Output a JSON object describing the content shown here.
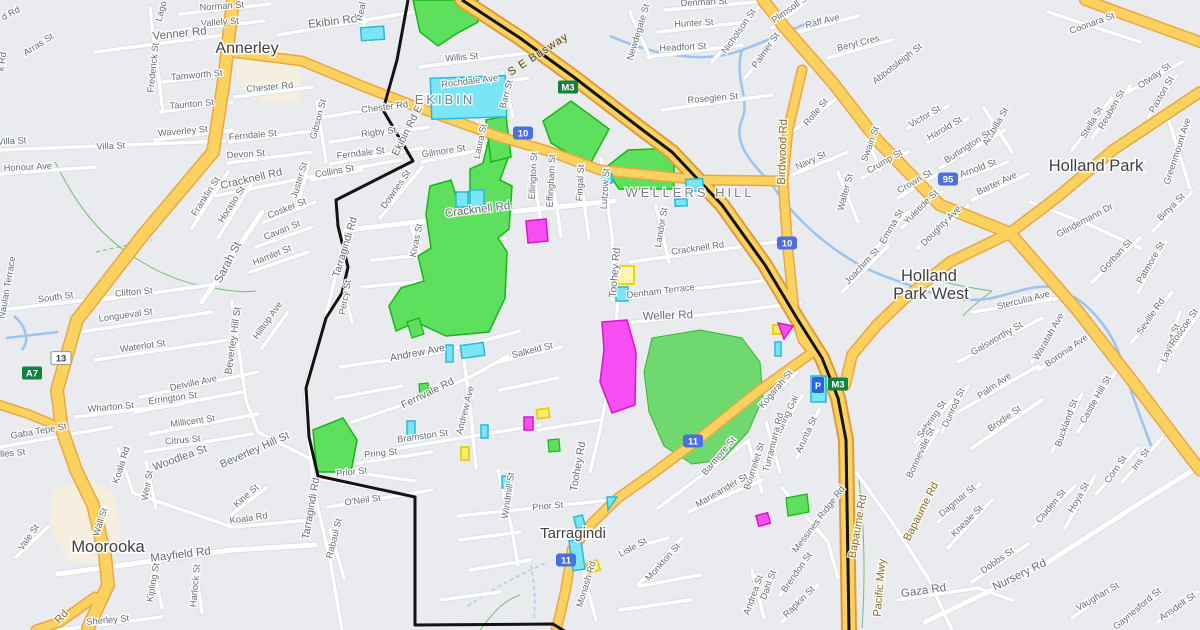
{
  "colors": {
    "bg": "#e9ebee",
    "road_white": "#ffffff",
    "road_casing": "#d9dbdf",
    "road_yellow": "#fbd160",
    "road_yellow_casing": "#eba743",
    "motorway_fill": "#fbd160",
    "motorway_casing": "#de9a3b",
    "boundary_black": "#131313",
    "water": "#9dc3f0",
    "park_fill": "#5ee05e",
    "park_stroke": "#15b715",
    "park_soft": "#6fd86f",
    "parcel_cyan": "#7ae6f5",
    "parcel_cyan_stroke": "#2bb8d8",
    "parcel_magenta": "#f74ef3",
    "parcel_magenta_stroke": "#d816ce",
    "parcel_yellow": "#f9ed6a",
    "parcel_yellow_stroke": "#e8cf1a",
    "parcel_blue": "#2a66d9",
    "commercial": "#f6efdf",
    "shield_green": "#12813f",
    "shield_blue": "#4a6fdf",
    "trail_green": "#4caf50"
  },
  "suburbs": [
    {
      "t": "Annerley",
      "x": 247,
      "y": 53,
      "s": 16
    },
    {
      "t": "EKIBIN",
      "x": 445,
      "y": 104,
      "caps": true
    },
    {
      "t": "WELLERS HILL",
      "x": 690,
      "y": 197,
      "caps": true
    },
    {
      "t": "Holland Park",
      "x": 1096,
      "y": 171,
      "s": 16.5
    },
    {
      "t": "Holland",
      "x": 929,
      "y": 281,
      "s": 16.5
    },
    {
      "t": "Park West",
      "x": 931,
      "y": 299,
      "s": 16.5
    },
    {
      "t": "Moorooka",
      "x": 108,
      "y": 552,
      "s": 16.5
    },
    {
      "t": "Tarragindi",
      "x": 573,
      "y": 538,
      "s": 15
    }
  ],
  "shields": [
    {
      "t": "M3",
      "x": 568,
      "y": 87,
      "k": "g"
    },
    {
      "t": "M3",
      "x": 838,
      "y": 384,
      "k": "g"
    },
    {
      "t": "10",
      "x": 523,
      "y": 133,
      "k": "b"
    },
    {
      "t": "10",
      "x": 787,
      "y": 243,
      "k": "b"
    },
    {
      "t": "11",
      "x": 693,
      "y": 441,
      "k": "b"
    },
    {
      "t": "11",
      "x": 566,
      "y": 560,
      "k": "b"
    },
    {
      "t": "95",
      "x": 948,
      "y": 179,
      "k": "b"
    },
    {
      "t": "13",
      "x": 61,
      "y": 358,
      "k": "w"
    },
    {
      "t": "A7",
      "x": 32,
      "y": 373,
      "k": "g"
    }
  ],
  "streets": [
    {
      "t": "Norman St",
      "x": 222,
      "y": 9,
      "r": -4
    },
    {
      "t": "Vallely St",
      "x": 220,
      "y": 25,
      "r": -4
    },
    {
      "t": "Venner Rd",
      "x": 180,
      "y": 37,
      "r": -6,
      "s": 11.5
    },
    {
      "t": "Arras St",
      "x": 40,
      "y": 47,
      "r": -33
    },
    {
      "t": "d Rd",
      "x": 12,
      "y": 16,
      "r": -28
    },
    {
      "t": "k Rd",
      "x": 5,
      "y": 62,
      "r": -82
    },
    {
      "t": "Lago",
      "x": 164,
      "y": 12,
      "r": -75
    },
    {
      "t": "Frederick St",
      "x": 156,
      "y": 68,
      "r": -84
    },
    {
      "t": "Tamworth St",
      "x": 197,
      "y": 78,
      "r": -5
    },
    {
      "t": "Chester Rd",
      "x": 270,
      "y": 90,
      "r": -5
    },
    {
      "t": "Taunton St",
      "x": 192,
      "y": 107,
      "r": -5
    },
    {
      "t": "Waverley St",
      "x": 183,
      "y": 134,
      "r": -5
    },
    {
      "t": "Ferndale St",
      "x": 253,
      "y": 138,
      "r": -5
    },
    {
      "t": "Villa St",
      "x": 111,
      "y": 149,
      "r": -3
    },
    {
      "t": "Villa St",
      "x": 12,
      "y": 144,
      "r": -3
    },
    {
      "t": "Devon St",
      "x": 246,
      "y": 157,
      "r": -4
    },
    {
      "t": "Honour Ave",
      "x": 28,
      "y": 170,
      "r": -3
    },
    {
      "t": "Ekibin Rd",
      "x": 333,
      "y": 25,
      "r": -7,
      "s": 11.5
    },
    {
      "t": "Real",
      "x": 364,
      "y": 12,
      "r": -80
    },
    {
      "t": "Willis St",
      "x": 462,
      "y": 60,
      "r": -5
    },
    {
      "t": "Rochdale Ave",
      "x": 470,
      "y": 84,
      "r": -7
    },
    {
      "t": "Chester Rd",
      "x": 385,
      "y": 110,
      "r": -7
    },
    {
      "t": "Gibson St",
      "x": 321,
      "y": 120,
      "r": -75
    },
    {
      "t": "Rigby St",
      "x": 379,
      "y": 135,
      "r": -7
    },
    {
      "t": "Ferndale St",
      "x": 361,
      "y": 156,
      "r": -7
    },
    {
      "t": "Gilmore St",
      "x": 444,
      "y": 154,
      "r": -9
    },
    {
      "t": "Laura St",
      "x": 483,
      "y": 142,
      "r": -78
    },
    {
      "t": "Barr St",
      "x": 509,
      "y": 95,
      "r": -75
    },
    {
      "t": "Ekibin Rd E",
      "x": 410,
      "y": 132,
      "r": -63,
      "s": 10.5
    },
    {
      "t": "Downes St",
      "x": 398,
      "y": 191,
      "r": -55
    },
    {
      "t": "Collins St",
      "x": 335,
      "y": 174,
      "r": -10
    },
    {
      "t": "S E Busway",
      "x": 540,
      "y": 57,
      "r": -33,
      "k": "bus"
    },
    {
      "t": "Cracknell Rd",
      "x": 252,
      "y": 182,
      "r": -13,
      "s": 11
    },
    {
      "t": "Franklin St",
      "x": 208,
      "y": 198,
      "r": -57
    },
    {
      "t": "Horatio St",
      "x": 234,
      "y": 206,
      "r": -57
    },
    {
      "t": "Cosker St",
      "x": 288,
      "y": 211,
      "r": -22
    },
    {
      "t": "Cavan St",
      "x": 283,
      "y": 233,
      "r": -22
    },
    {
      "t": "Hamlet St",
      "x": 273,
      "y": 258,
      "r": -22
    },
    {
      "t": "Sarah St",
      "x": 231,
      "y": 264,
      "r": -62,
      "s": 11.5
    },
    {
      "t": "Juster St",
      "x": 302,
      "y": 181,
      "r": -73
    },
    {
      "t": "Cracknell Rd",
      "x": 478,
      "y": 213,
      "r": -7,
      "s": 11.5
    },
    {
      "t": "Kivas St",
      "x": 419,
      "y": 241,
      "r": -78
    },
    {
      "t": "Tarragindi Rd",
      "x": 348,
      "y": 248,
      "r": -73,
      "s": 10.5
    },
    {
      "t": "Percy St",
      "x": 348,
      "y": 298,
      "r": -80
    },
    {
      "t": "Ellington St",
      "x": 536,
      "y": 176,
      "r": -87
    },
    {
      "t": "Effingham St",
      "x": 554,
      "y": 181,
      "r": -87
    },
    {
      "t": "Fingal St",
      "x": 583,
      "y": 183,
      "r": -87
    },
    {
      "t": "Lutzow St",
      "x": 608,
      "y": 189,
      "r": -86
    },
    {
      "t": "Landor St",
      "x": 664,
      "y": 228,
      "r": -80
    },
    {
      "t": "Cracknell Rd",
      "x": 698,
      "y": 251,
      "r": -8
    },
    {
      "t": "Toohey Rd",
      "x": 618,
      "y": 273,
      "r": -85,
      "s": 10.5
    },
    {
      "t": "Denham Terrace",
      "x": 661,
      "y": 294,
      "r": -7
    },
    {
      "t": "Weller Rd",
      "x": 668,
      "y": 319,
      "r": -2,
      "s": 11.5
    },
    {
      "t": "Birdwood Rd",
      "x": 786,
      "y": 152,
      "r": -88,
      "s": 11.5,
      "k": "rd"
    },
    {
      "t": "Navy St",
      "x": 812,
      "y": 163,
      "r": -25
    },
    {
      "t": "Walter St",
      "x": 848,
      "y": 193,
      "r": -75
    },
    {
      "t": "Crump St",
      "x": 886,
      "y": 164,
      "r": -30
    },
    {
      "t": "Joachim St",
      "x": 864,
      "y": 268,
      "r": -47
    },
    {
      "t": "Emma St",
      "x": 894,
      "y": 228,
      "r": -60
    },
    {
      "t": "Denman St",
      "x": 704,
      "y": 5,
      "r": -3
    },
    {
      "t": "Hunter St",
      "x": 694,
      "y": 26,
      "r": -3
    },
    {
      "t": "Headfort St",
      "x": 683,
      "y": 50,
      "r": -3
    },
    {
      "t": "Newdegate St",
      "x": 641,
      "y": 33,
      "r": -73
    },
    {
      "t": "Nicholson St",
      "x": 741,
      "y": 33,
      "r": -55
    },
    {
      "t": "Palmer St",
      "x": 768,
      "y": 52,
      "r": -55
    },
    {
      "t": "Plimsoll St",
      "x": 792,
      "y": 11,
      "r": -35
    },
    {
      "t": "Raff Ave",
      "x": 823,
      "y": 24,
      "r": -14
    },
    {
      "t": "Beryl Cres",
      "x": 859,
      "y": 46,
      "r": -14
    },
    {
      "t": "Abbotsleigh St",
      "x": 899,
      "y": 66,
      "r": -38
    },
    {
      "t": "Roseglen St",
      "x": 713,
      "y": 101,
      "r": -5
    },
    {
      "t": "Rolle St",
      "x": 818,
      "y": 114,
      "r": -50
    },
    {
      "t": "Swain St",
      "x": 873,
      "y": 145,
      "r": -70
    },
    {
      "t": "Coonara St",
      "x": 1093,
      "y": 26,
      "r": -20
    },
    {
      "t": "Victor St",
      "x": 926,
      "y": 119,
      "r": -30
    },
    {
      "t": "Harold St",
      "x": 946,
      "y": 131,
      "r": -30
    },
    {
      "t": "Arabilla St",
      "x": 998,
      "y": 128,
      "r": -60
    },
    {
      "t": "Burlington St",
      "x": 969,
      "y": 149,
      "r": -33
    },
    {
      "t": "Otway St",
      "x": 1156,
      "y": 78,
      "r": -35
    },
    {
      "t": "Paxton St",
      "x": 1164,
      "y": 96,
      "r": -60
    },
    {
      "t": "Reuben St",
      "x": 1114,
      "y": 111,
      "r": -60
    },
    {
      "t": "Stella St",
      "x": 1094,
      "y": 124,
      "r": -60
    },
    {
      "t": "Greenmount Ave",
      "x": 1180,
      "y": 152,
      "r": -72
    },
    {
      "t": "Crown St",
      "x": 916,
      "y": 184,
      "r": -30
    },
    {
      "t": "Yuletide St",
      "x": 923,
      "y": 209,
      "r": -45
    },
    {
      "t": "Arnold St",
      "x": 979,
      "y": 171,
      "r": -20
    },
    {
      "t": "Barter Ave",
      "x": 998,
      "y": 186,
      "r": -25
    },
    {
      "t": "Doughty Ave",
      "x": 943,
      "y": 228,
      "r": -45
    },
    {
      "t": "Glindemann Dr",
      "x": 1086,
      "y": 223,
      "r": -28
    },
    {
      "t": "Gorban St",
      "x": 1118,
      "y": 258,
      "r": -47
    },
    {
      "t": "Patmore St",
      "x": 1153,
      "y": 264,
      "r": -60
    },
    {
      "t": "Binya St",
      "x": 1173,
      "y": 209,
      "r": -45
    },
    {
      "t": "Sterculia Ave",
      "x": 1024,
      "y": 303,
      "r": -14
    },
    {
      "t": "Seville Rd",
      "x": 1153,
      "y": 318,
      "r": -55
    },
    {
      "t": "Galsworthy St",
      "x": 998,
      "y": 341,
      "r": -30
    },
    {
      "t": "Waratah Ave",
      "x": 1051,
      "y": 338,
      "r": -60
    },
    {
      "t": "Boronia Ave",
      "x": 1068,
      "y": 353,
      "r": -35
    },
    {
      "t": "Palm Ave",
      "x": 996,
      "y": 388,
      "r": -35
    },
    {
      "t": "Dunrod St",
      "x": 956,
      "y": 409,
      "r": -65
    },
    {
      "t": "Sebring St",
      "x": 934,
      "y": 421,
      "r": -55
    },
    {
      "t": "Bonneville St",
      "x": 923,
      "y": 454,
      "r": -65
    },
    {
      "t": "Brodie St",
      "x": 1006,
      "y": 421,
      "r": -35
    },
    {
      "t": "Buckland St",
      "x": 1069,
      "y": 424,
      "r": -70
    },
    {
      "t": "Castle Hill St",
      "x": 1098,
      "y": 401,
      "r": -60
    },
    {
      "t": "Iris St",
      "x": 1143,
      "y": 461,
      "r": -55
    },
    {
      "t": "Corn St",
      "x": 1118,
      "y": 471,
      "r": -55
    },
    {
      "t": "Layard St",
      "x": 1173,
      "y": 344,
      "r": -70
    },
    {
      "t": "Roscoe St",
      "x": 1186,
      "y": 329,
      "r": -55
    },
    {
      "t": "Waterlot St",
      "x": 143,
      "y": 349,
      "r": -8
    },
    {
      "t": "Delville Ave",
      "x": 194,
      "y": 386,
      "r": -12
    },
    {
      "t": "Errington St",
      "x": 173,
      "y": 401,
      "r": -8
    },
    {
      "t": "Wharton St",
      "x": 111,
      "y": 410,
      "r": -5
    },
    {
      "t": "Millicent St",
      "x": 193,
      "y": 424,
      "r": -8
    },
    {
      "t": "Citrus St",
      "x": 183,
      "y": 443,
      "r": -5
    },
    {
      "t": "Gaba Tepe St",
      "x": 39,
      "y": 434,
      "r": -10
    },
    {
      "t": "lles St",
      "x": 13,
      "y": 456,
      "r": -5
    },
    {
      "t": "Woodlea St",
      "x": 181,
      "y": 461,
      "r": -20,
      "s": 11
    },
    {
      "t": "Koala Rd",
      "x": 124,
      "y": 466,
      "r": -72
    },
    {
      "t": "Weir St",
      "x": 150,
      "y": 486,
      "r": -80
    },
    {
      "t": "Beverley Hill St",
      "x": 236,
      "y": 341,
      "r": -82,
      "s": 10
    },
    {
      "t": "Hilltop Ave",
      "x": 270,
      "y": 322,
      "r": -55
    },
    {
      "t": "Beverley Hill St",
      "x": 256,
      "y": 453,
      "r": -24,
      "s": 11
    },
    {
      "t": "Longueval St",
      "x": 126,
      "y": 318,
      "r": -8
    },
    {
      "t": "Clifton St",
      "x": 134,
      "y": 295,
      "r": -5
    },
    {
      "t": "South St",
      "x": 56,
      "y": 300,
      "r": -8
    },
    {
      "t": "Naulan Terrace",
      "x": 10,
      "y": 288,
      "r": -80
    },
    {
      "t": "Koala Rd",
      "x": 249,
      "y": 521,
      "r": -8
    },
    {
      "t": "Kine St",
      "x": 248,
      "y": 498,
      "r": -42
    },
    {
      "t": "Mayfield Rd",
      "x": 181,
      "y": 558,
      "r": -7,
      "s": 11.5
    },
    {
      "t": "Wall St",
      "x": 103,
      "y": 523,
      "r": -72
    },
    {
      "t": "Vale St",
      "x": 31,
      "y": 539,
      "r": -55
    },
    {
      "t": "Kipling St",
      "x": 156,
      "y": 583,
      "r": -80
    },
    {
      "t": "Harlock St",
      "x": 198,
      "y": 586,
      "r": -85
    },
    {
      "t": "Sherley St",
      "x": 108,
      "y": 623,
      "r": -5
    },
    {
      "t": "Rd",
      "x": 64,
      "y": 619,
      "r": -48,
      "k": "rd"
    },
    {
      "t": "Andrew Ave",
      "x": 418,
      "y": 356,
      "r": -11,
      "s": 10.5
    },
    {
      "t": "Salkeld St",
      "x": 533,
      "y": 353,
      "r": -14
    },
    {
      "t": "Fernvale Rd",
      "x": 429,
      "y": 396,
      "r": -26,
      "s": 10.5
    },
    {
      "t": "Andrew Ave",
      "x": 468,
      "y": 411,
      "r": -76
    },
    {
      "t": "Bramston St",
      "x": 423,
      "y": 439,
      "r": -8
    },
    {
      "t": "Pring St",
      "x": 381,
      "y": 456,
      "r": -6
    },
    {
      "t": "Prior St",
      "x": 352,
      "y": 475,
      "r": -6
    },
    {
      "t": "O'Neil St",
      "x": 363,
      "y": 503,
      "r": -8
    },
    {
      "t": "Tarragindi Rd",
      "x": 314,
      "y": 509,
      "r": -80,
      "s": 10.5
    },
    {
      "t": "Rabaul St",
      "x": 337,
      "y": 539,
      "r": -76
    },
    {
      "t": "Prior St",
      "x": 548,
      "y": 509,
      "r": -5
    },
    {
      "t": "Windmill St",
      "x": 511,
      "y": 496,
      "r": -82
    },
    {
      "t": "Toohey Rd",
      "x": 581,
      "y": 467,
      "r": -80,
      "s": 10.5
    },
    {
      "t": "Monash Rd",
      "x": 589,
      "y": 585,
      "r": -73
    },
    {
      "t": "Kogarah St",
      "x": 778,
      "y": 391,
      "r": -50
    },
    {
      "t": "Kuring Gai",
      "x": 789,
      "y": 417,
      "r": -65
    },
    {
      "t": "Turramurra Rd",
      "x": 776,
      "y": 443,
      "r": -76
    },
    {
      "t": "Arunta St",
      "x": 809,
      "y": 436,
      "r": -65
    },
    {
      "t": "Barmore St",
      "x": 721,
      "y": 458,
      "r": -50
    },
    {
      "t": "Bourrelet St",
      "x": 757,
      "y": 467,
      "r": -72
    },
    {
      "t": "Lisle St",
      "x": 634,
      "y": 550,
      "r": -28
    },
    {
      "t": "Monkton St",
      "x": 665,
      "y": 564,
      "r": -48
    },
    {
      "t": "Marieander St",
      "x": 723,
      "y": 493,
      "r": -30
    },
    {
      "t": "Messines Ridge Rd",
      "x": 821,
      "y": 521,
      "r": -53
    },
    {
      "t": "Bapaume Rd",
      "x": 861,
      "y": 527,
      "r": -80,
      "k": "rd"
    },
    {
      "t": "Pacific Mwy",
      "x": 883,
      "y": 588,
      "r": -85,
      "k": "rd"
    },
    {
      "t": "Bapaume Rd",
      "x": 924,
      "y": 513,
      "r": -63,
      "k": "rd"
    },
    {
      "t": "Dahl St",
      "x": 771,
      "y": 586,
      "r": -70
    },
    {
      "t": "Brendon St",
      "x": 799,
      "y": 574,
      "r": -55
    },
    {
      "t": "Andrea St",
      "x": 756,
      "y": 596,
      "r": -70
    },
    {
      "t": "Rapkin St",
      "x": 801,
      "y": 604,
      "r": -45
    },
    {
      "t": "Dagmar St",
      "x": 959,
      "y": 503,
      "r": -40
    },
    {
      "t": "Kneale St",
      "x": 969,
      "y": 523,
      "r": -45
    },
    {
      "t": "Cluden St",
      "x": 1053,
      "y": 508,
      "r": -50
    },
    {
      "t": "Hoya St",
      "x": 1081,
      "y": 499,
      "r": -60
    },
    {
      "t": "Dobbs St",
      "x": 999,
      "y": 563,
      "r": -35
    },
    {
      "t": "Nursery Rd",
      "x": 1021,
      "y": 578,
      "r": -26,
      "s": 11.5
    },
    {
      "t": "Gaza Rd",
      "x": 924,
      "y": 594,
      "r": -8,
      "s": 11.5
    },
    {
      "t": "Vaughan St",
      "x": 1099,
      "y": 599,
      "r": -30
    },
    {
      "t": "Gaynesford St",
      "x": 1139,
      "y": 611,
      "r": -40
    },
    {
      "t": "Ansdell St",
      "x": 1179,
      "y": 609,
      "r": -35
    }
  ]
}
